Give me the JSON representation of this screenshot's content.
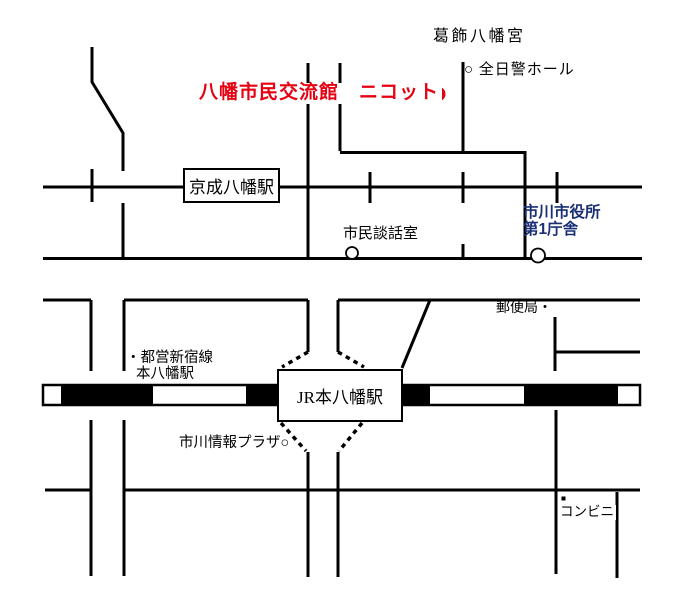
{
  "map": {
    "labels": {
      "shrine": "葛飾八幡宮",
      "hall": "○ 全日警ホール",
      "destination": "八幡市民交流館　ニコット",
      "keisei_station": "京成八幡駅",
      "danwashitsu": "市民談話室",
      "city_hall_1": "市川市役所",
      "city_hall_2": "第1庁舎",
      "post_office": "郵便局・",
      "toei_1": "・都営新宿線",
      "toei_2": "本八幡駅",
      "jr_station": "JR本八幡駅",
      "plaza": "市川情報プラザ○",
      "konbini": "コンビニ"
    },
    "colors": {
      "destination_marker": "#e60012",
      "city_hall_text": "#1b2f75",
      "line": "#000000",
      "background": "#ffffff"
    }
  }
}
